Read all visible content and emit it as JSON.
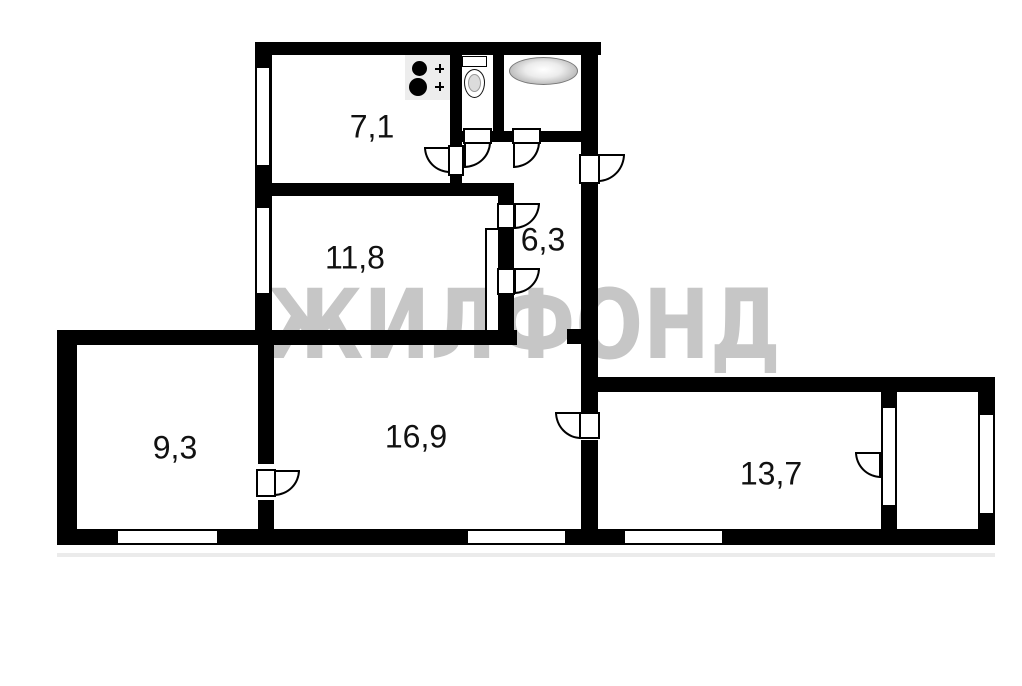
{
  "plan": {
    "background_color": "#ffffff",
    "wall_color": "#000000",
    "label_color": "#111111",
    "watermark": {
      "text": "ЖИЛФОНД",
      "color": "#c6c6c6"
    },
    "rooms": [
      {
        "id": "kitchen",
        "area_label": "7,1"
      },
      {
        "id": "room-top",
        "area_label": "11,8"
      },
      {
        "id": "hallway",
        "area_label": "6,3"
      },
      {
        "id": "room-bottom-left",
        "area_label": "9,3"
      },
      {
        "id": "room-center",
        "area_label": "16,9"
      },
      {
        "id": "room-right",
        "area_label": "13,7"
      }
    ],
    "fixtures": [
      {
        "icon": "stove-icon"
      },
      {
        "icon": "toilet-icon"
      },
      {
        "icon": "bathtub-icon"
      }
    ]
  }
}
